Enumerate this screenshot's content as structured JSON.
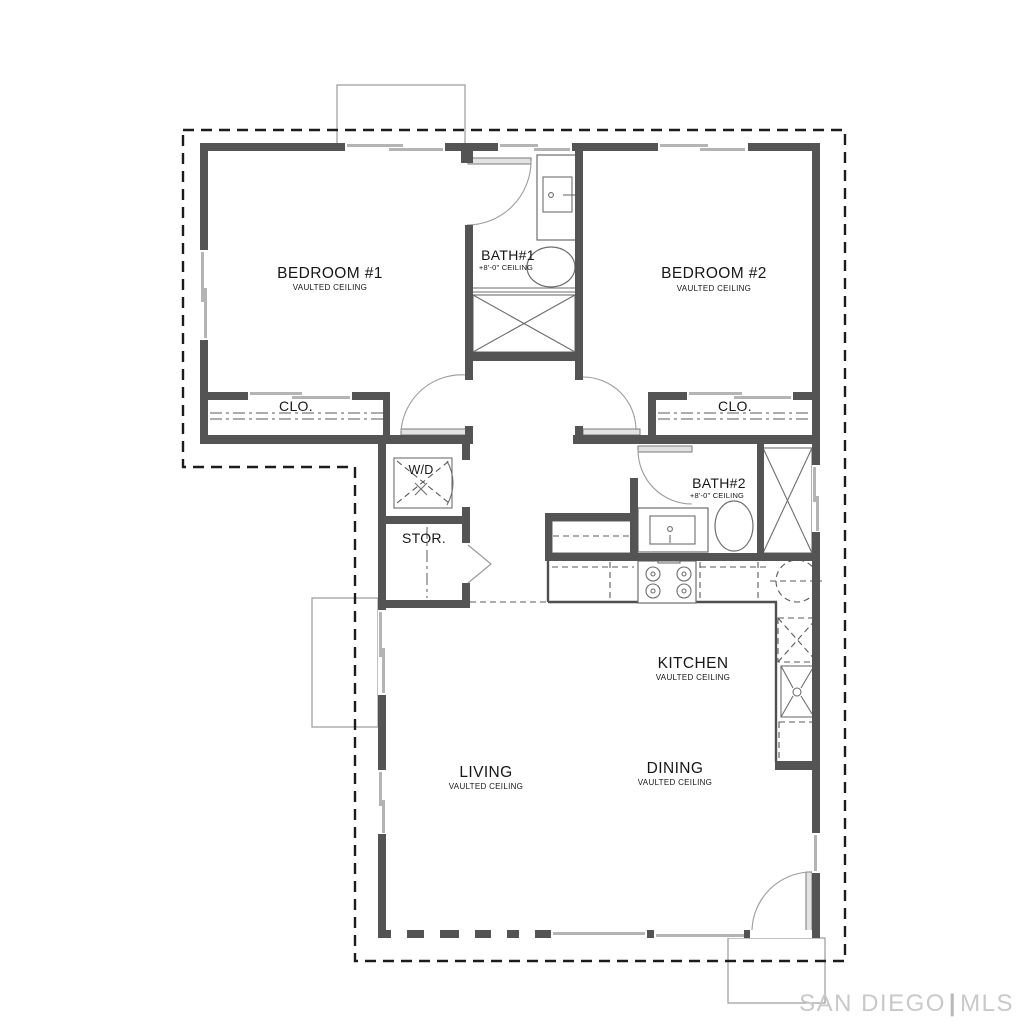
{
  "title": "Floor Plan",
  "theme": {
    "wall": "#545454",
    "ink": "#1c1c1c",
    "thin": "#9a9a9a",
    "window": "#b4b4b4",
    "fixture": "#6e6e6e",
    "watermark": "#c9c9c9",
    "bg": "#ffffff"
  },
  "rooms": {
    "bedroom1": {
      "label": "BEDROOM #1",
      "sub": "VAULTED CEILING"
    },
    "bedroom2": {
      "label": "BEDROOM #2",
      "sub": "VAULTED CEILING"
    },
    "bath1": {
      "label": "BATH#1",
      "sub": "+8'-0\" CEILING"
    },
    "bath2": {
      "label": "BATH#2",
      "sub": "+8'-0\" CEILING"
    },
    "closet1": {
      "label": "CLO."
    },
    "closet2": {
      "label": "CLO."
    },
    "laundry": {
      "label": "W/D"
    },
    "storage": {
      "label": "STOR."
    },
    "kitchen": {
      "label": "KITCHEN",
      "sub": "VAULTED CEILING"
    },
    "living": {
      "label": "LIVING",
      "sub": "VAULTED CEILING"
    },
    "dining": {
      "label": "DINING",
      "sub": "VAULTED CEILING"
    }
  },
  "watermark": {
    "brand": "SAN DIEGO",
    "divider": "|",
    "suffix": "MLS"
  }
}
